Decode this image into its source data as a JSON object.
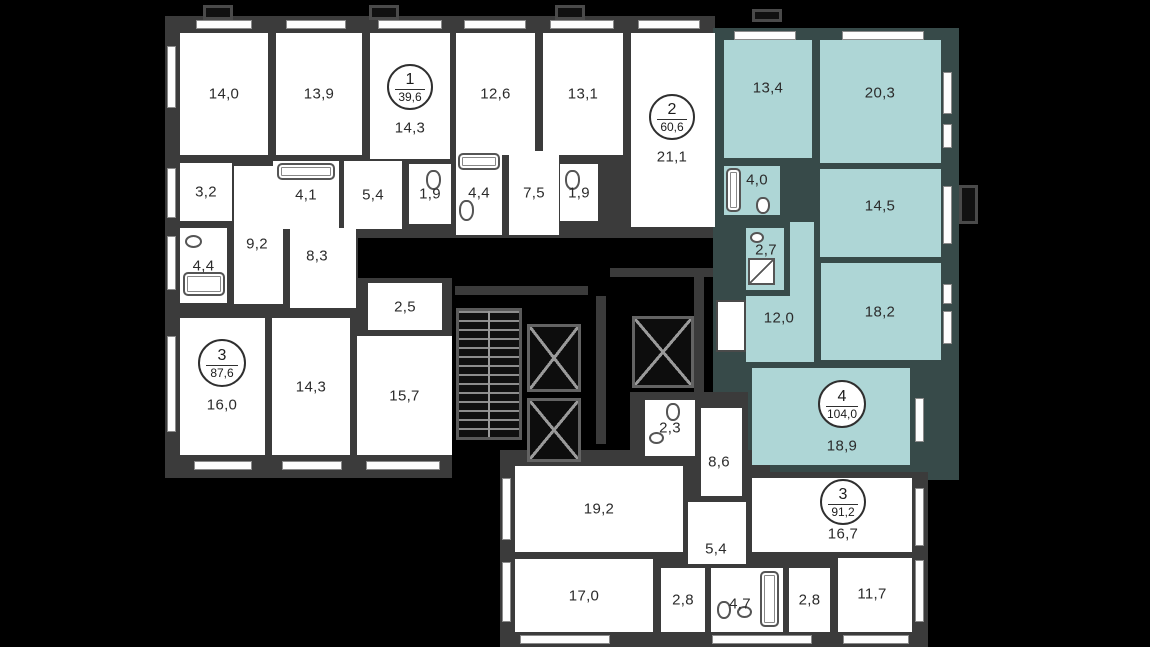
{
  "title": "Residential floor plan",
  "colors": {
    "background": "#000000",
    "walls": "#3b3b3b",
    "room_fill": "#ffffff",
    "highlight_fill": "#aed6d6",
    "highlight_walls": "#374a49",
    "label_text": "#2b2b2b"
  },
  "apartments": [
    {
      "number": "1",
      "area": "39,6",
      "highlighted": false
    },
    {
      "number": "2",
      "area": "60,6",
      "highlighted": false
    },
    {
      "number": "3",
      "area": "87,6",
      "highlighted": false
    },
    {
      "number": "4",
      "area": "104,0",
      "highlighted": true
    },
    {
      "number": "3",
      "area": "91,2",
      "highlighted": false
    }
  ],
  "rooms": [
    {
      "label": "14,0",
      "apartment": "3"
    },
    {
      "label": "13,9",
      "apartment": "1"
    },
    {
      "label": "14,3",
      "apartment": "1"
    },
    {
      "label": "12,6",
      "apartment": "2"
    },
    {
      "label": "13,1",
      "apartment": "2"
    },
    {
      "label": "21,1",
      "apartment": "2"
    },
    {
      "label": "3,2",
      "apartment": "3"
    },
    {
      "label": "4,1",
      "apartment": "1"
    },
    {
      "label": "5,4",
      "apartment": "1"
    },
    {
      "label": "1,9",
      "apartment": "1"
    },
    {
      "label": "4,4",
      "apartment": "2"
    },
    {
      "label": "7,5",
      "apartment": "2"
    },
    {
      "label": "1,9",
      "apartment": "2"
    },
    {
      "label": "9,2",
      "apartment": "3"
    },
    {
      "label": "4,4",
      "apartment": "3"
    },
    {
      "label": "8,3",
      "apartment": "3"
    },
    {
      "label": "2,5",
      "apartment": "3"
    },
    {
      "label": "16,0",
      "apartment": "3"
    },
    {
      "label": "14,3",
      "apartment": "3"
    },
    {
      "label": "15,7",
      "apartment": "3"
    },
    {
      "label": "13,4",
      "apartment": "4"
    },
    {
      "label": "20,3",
      "apartment": "4"
    },
    {
      "label": "4,0",
      "apartment": "4"
    },
    {
      "label": "14,5",
      "apartment": "4"
    },
    {
      "label": "12,0",
      "apartment": "4"
    },
    {
      "label": "2,7",
      "apartment": "4"
    },
    {
      "label": "18,2",
      "apartment": "4"
    },
    {
      "label": "18,9",
      "apartment": "4"
    },
    {
      "label": "2,3",
      "apartment": "3"
    },
    {
      "label": "8,6",
      "apartment": "3"
    },
    {
      "label": "19,2",
      "apartment": "3"
    },
    {
      "label": "5,4",
      "apartment": "3"
    },
    {
      "label": "17,0",
      "apartment": "3"
    },
    {
      "label": "2,8",
      "apartment": "3"
    },
    {
      "label": "4,7",
      "apartment": "3"
    },
    {
      "label": "2,8",
      "apartment": "3"
    },
    {
      "label": "11,7",
      "apartment": "3"
    },
    {
      "label": "16,7",
      "apartment": "3"
    }
  ]
}
